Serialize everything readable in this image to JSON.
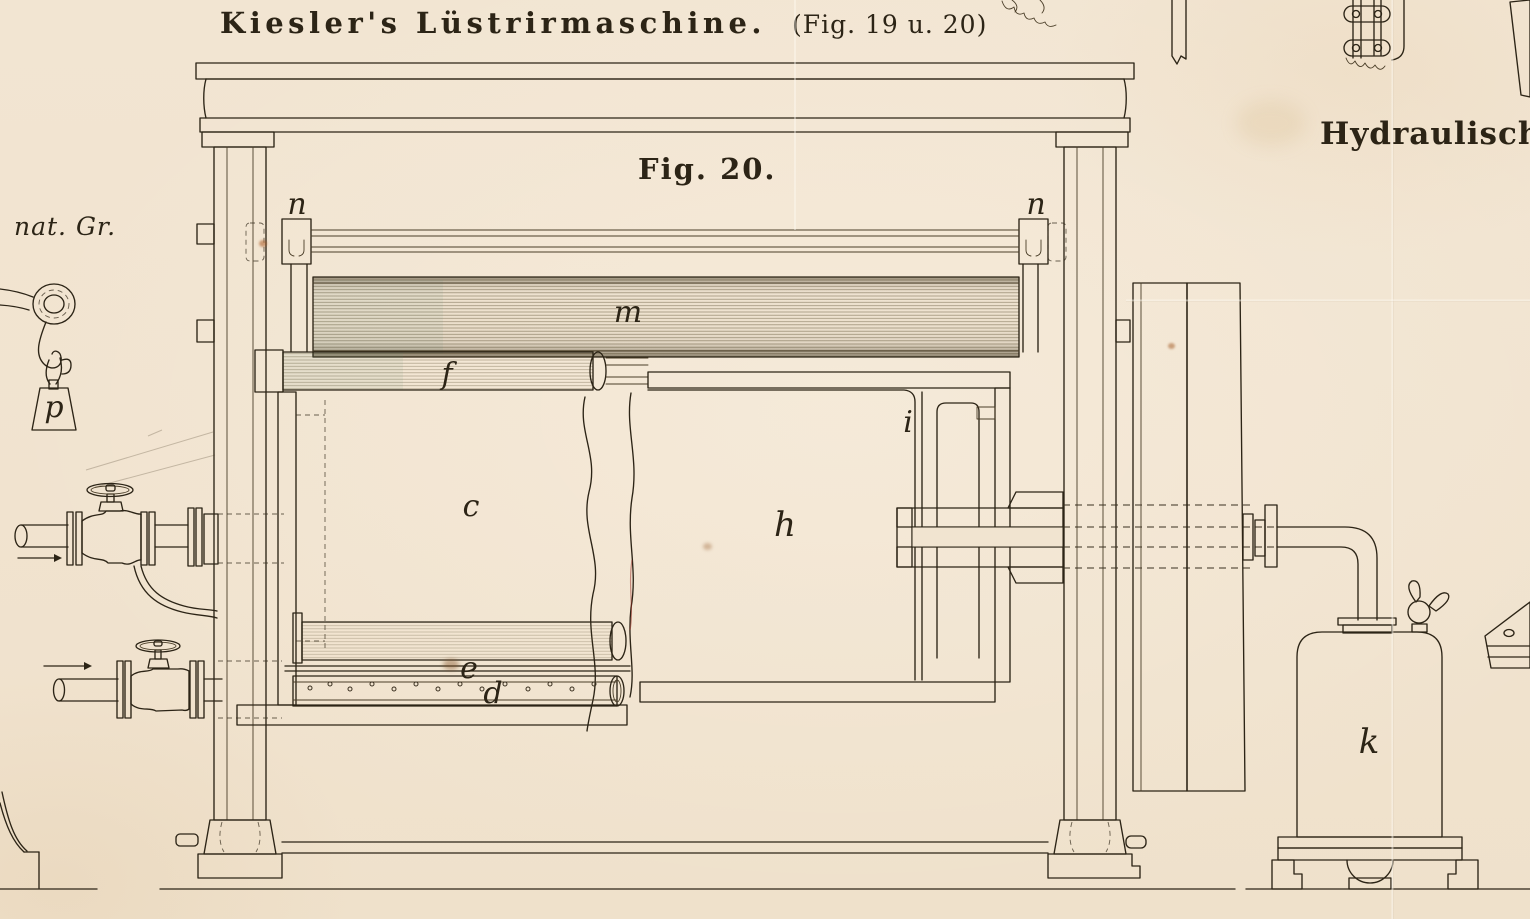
{
  "page": {
    "title": "Kiesler's Lüstrirmaschine.",
    "title_note": "(Fig. 19 u. 20)",
    "fig_caption": "Fig. 20.",
    "right_heading": "Hydraulische Ei",
    "scale_note": "nat. Gr."
  },
  "part_labels": {
    "n_left": "n",
    "n_right": "n",
    "m": "m",
    "f": "f",
    "c": "c",
    "h": "h",
    "i": "i",
    "e": "e",
    "d": "d",
    "k": "k",
    "p": "p"
  },
  "colors": {
    "paper": "#f1e4d0",
    "ink": "#2c2416",
    "hatch": "#3d3420",
    "aged_line": "#6e5f3c"
  }
}
